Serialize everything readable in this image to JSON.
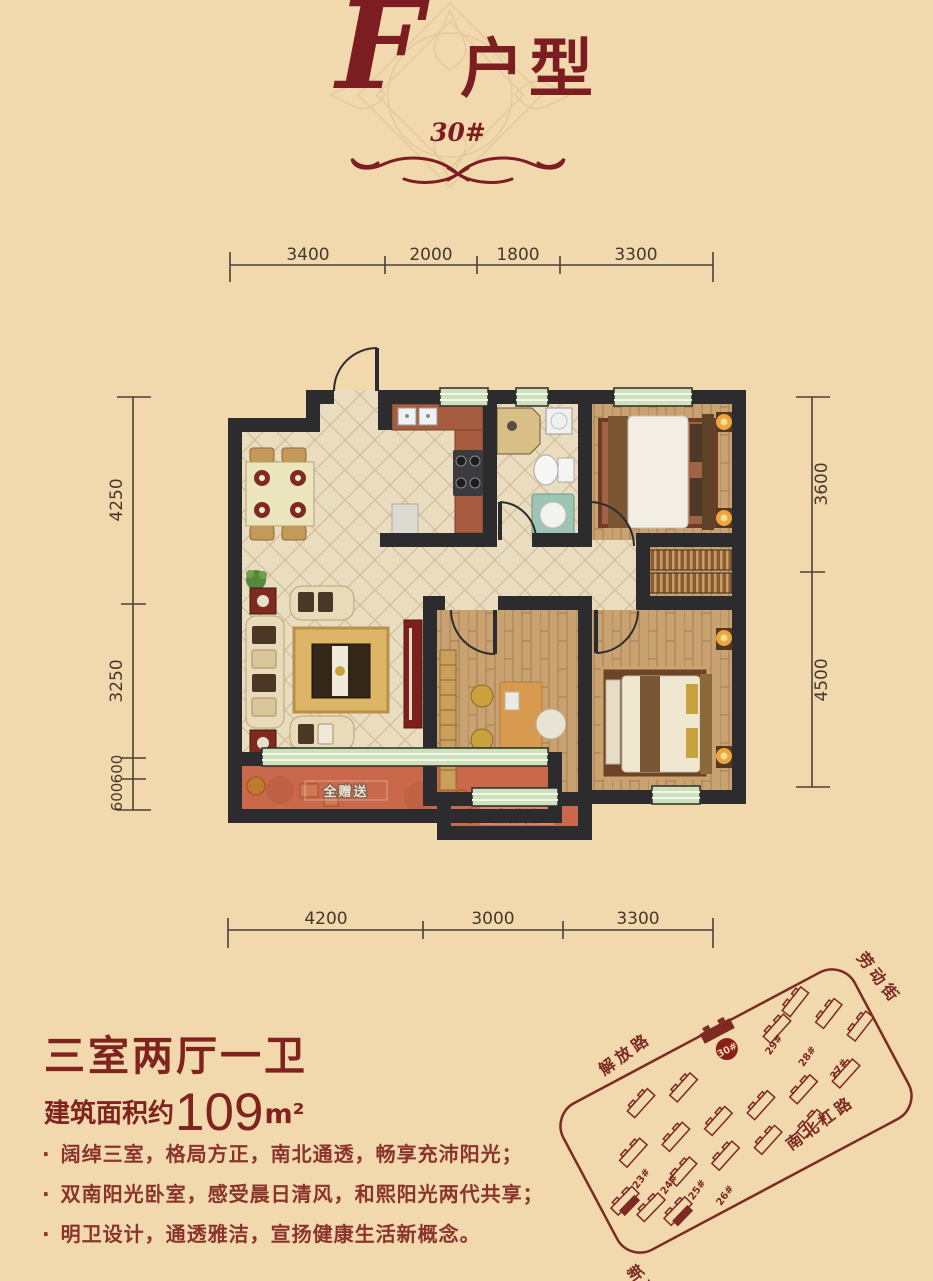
{
  "header": {
    "script_letter": "F",
    "title_suffix": "户型",
    "unit_number": "30#"
  },
  "dimensions": {
    "top": [
      "3400",
      "2000",
      "1800",
      "3300"
    ],
    "left": [
      "4250",
      "3250",
      "600",
      "600"
    ],
    "right": [
      "3600",
      "4500"
    ],
    "bottom": [
      "4200",
      "3000",
      "3300"
    ]
  },
  "floorplan": {
    "gift_label_living_balcony": "全赠送",
    "gift_label_study_balcony": "全赠送"
  },
  "summary": {
    "layout_title": "三室两厅一卫",
    "area_prefix": "建筑面积约",
    "area_value": "109",
    "area_unit": "m²"
  },
  "features": {
    "bullet": "·",
    "items": [
      "阔绰三室，格局方正，南北通透，畅享充沛阳光；",
      "双南阳光卧室，感受晨日清风，和熙阳光两代共享；",
      "明卫设计，通透雅洁，宣扬健康生活新概念。"
    ]
  },
  "sitemap": {
    "streets": {
      "top_left": "解放路",
      "top_right": "劳动街",
      "bottom_right": "南北杠路",
      "bottom_left": "新运大街"
    },
    "highlight_building": "30#",
    "buildings_right": [
      "29#",
      "28#",
      "27#"
    ],
    "buildings_left": [
      "23#",
      "24#",
      "25#",
      "26#"
    ]
  },
  "colors": {
    "accent": "#7c1d22",
    "wall": "#2c2c2e",
    "window_green": "#cde2b8",
    "balcony": "#c9684a"
  }
}
